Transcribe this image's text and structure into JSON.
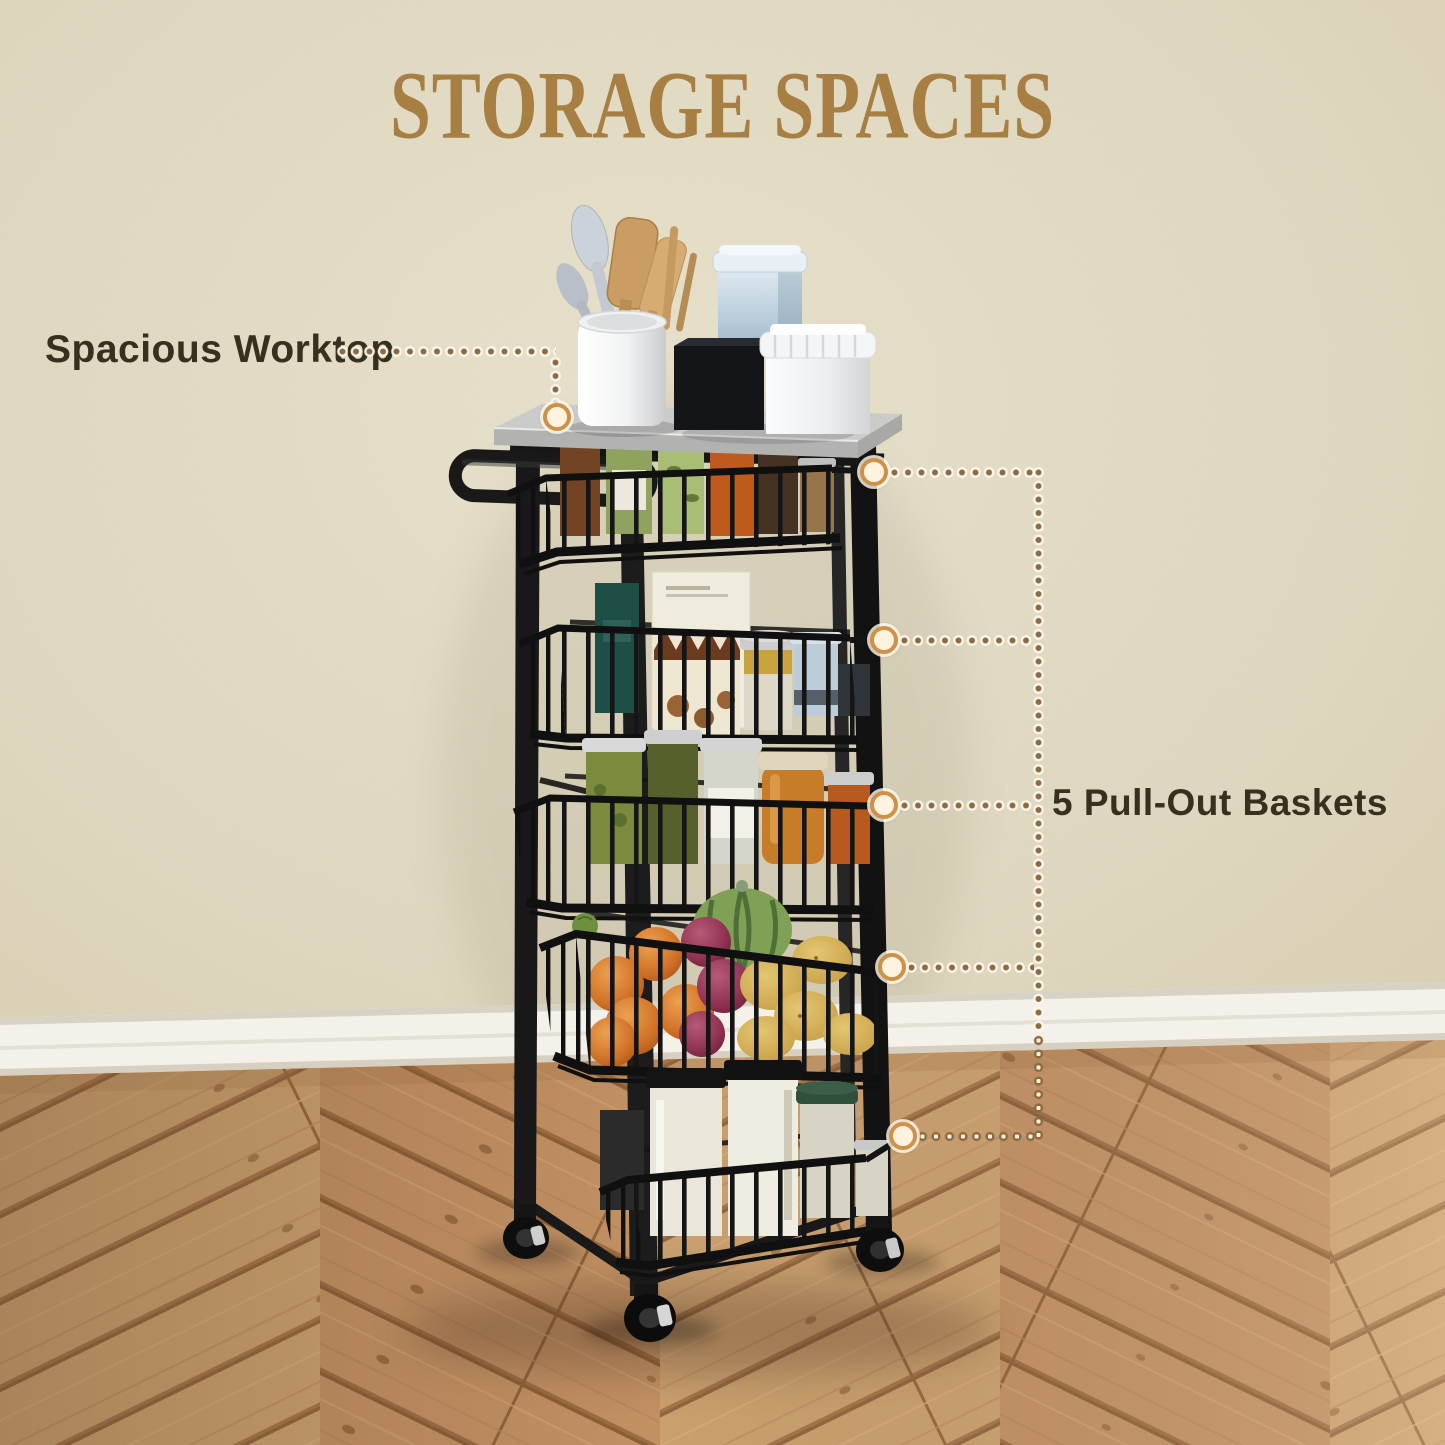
{
  "title": "STORAGE SPACES",
  "callouts": {
    "worktop": "Spacious Worktop",
    "baskets": "5 Pull-Out Baskets"
  },
  "palette": {
    "title": "#a87f42",
    "callout_text": "#37301f",
    "dots": "#8d6a3f",
    "marker_ring": "#cf9148",
    "marker_fill": "#fdf3de",
    "wall": "#ded6be",
    "baseboard": "#f3f1e9",
    "floor": "#c19063",
    "cart": "#181818",
    "worktop_surface": "#d2d2d0"
  },
  "scene": {
    "product": "5-tier rolling storage cart with worktop",
    "worktop_items": [
      "wooden-utensils",
      "utensil-crock",
      "blue-tin",
      "black-box",
      "white-canister"
    ],
    "baskets": [
      {
        "position": 1,
        "contents": "spice jars"
      },
      {
        "position": 2,
        "contents": "food boxes and canisters"
      },
      {
        "position": 3,
        "contents": "sauce and condiment jars"
      },
      {
        "position": 4,
        "contents": "onions, potatoes and squash"
      },
      {
        "position": 5,
        "contents": "dry-goods storage jars"
      }
    ],
    "casters": 3
  }
}
